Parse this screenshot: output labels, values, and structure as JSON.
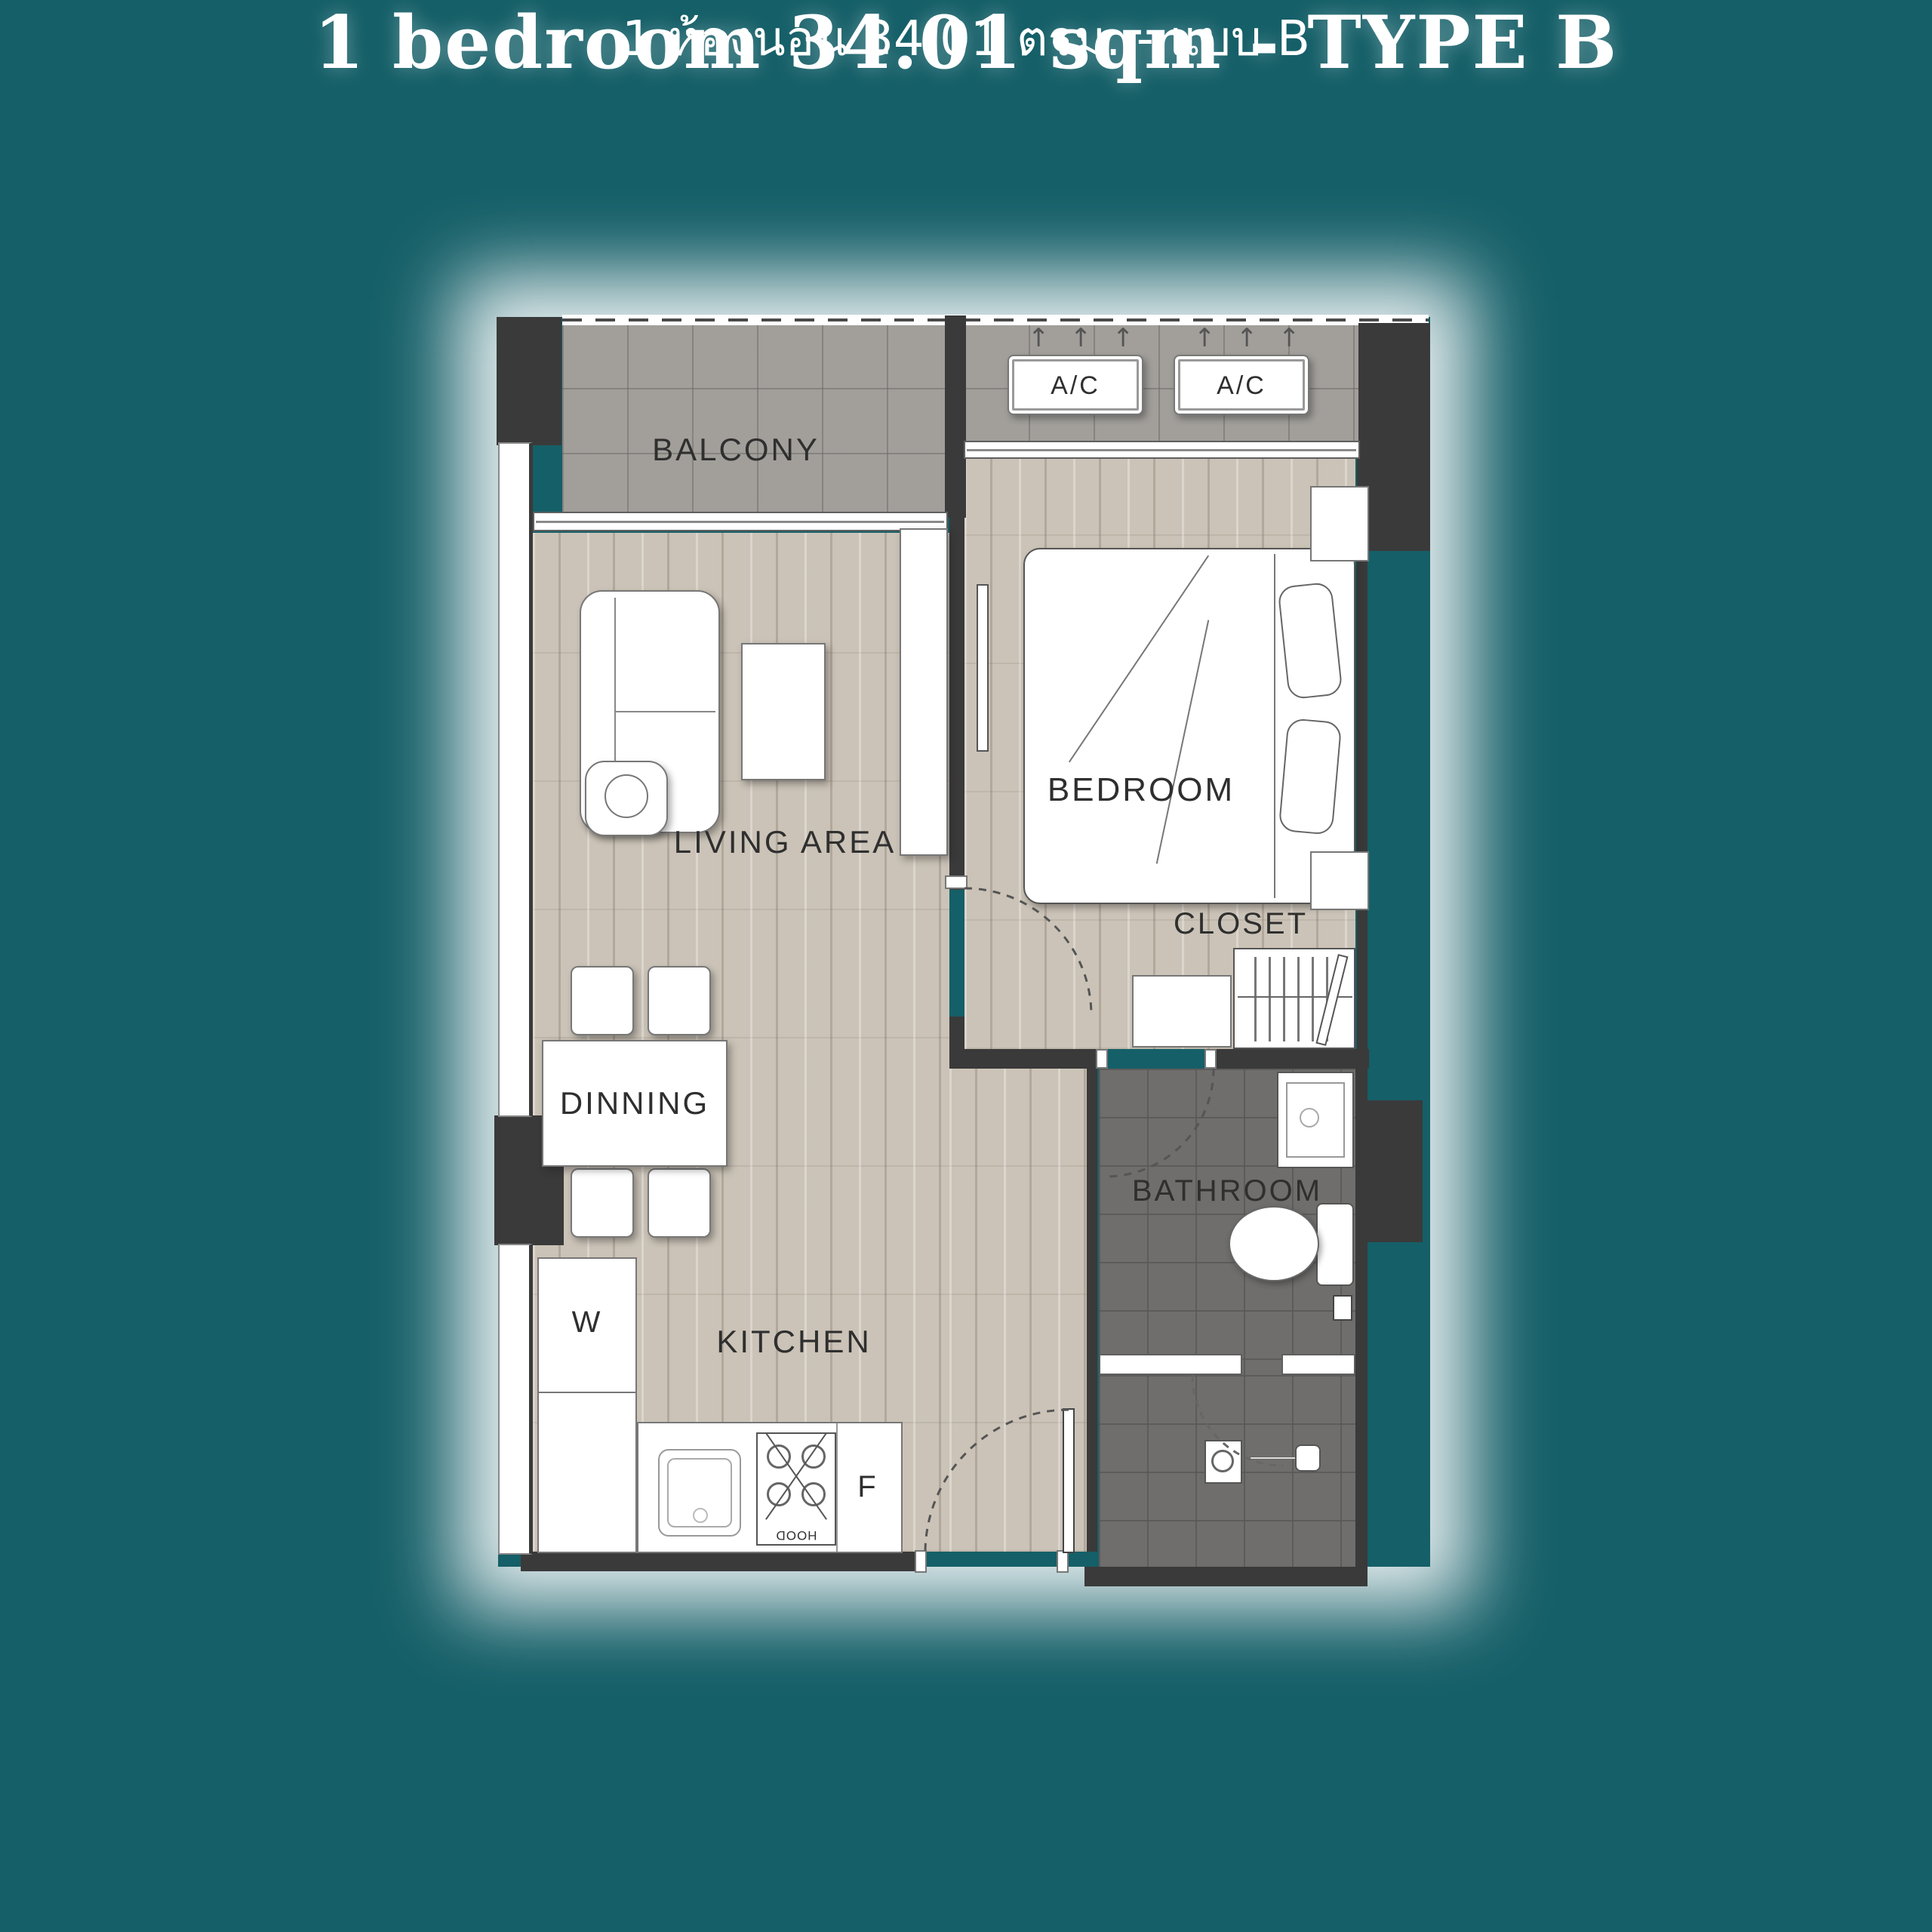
{
  "page": {
    "background": "#155F68"
  },
  "title": {
    "main": "1 bedroom 34.01 sqm - TYPE B",
    "sub": "1 ห้องนอน 34.01 ตรม. - แบบ B"
  },
  "plan": {
    "rooms": {
      "balcony": "BALCONY",
      "living_area": "LIVING AREA",
      "dining": "DINNING",
      "kitchen": "KITCHEN",
      "bedroom": "BEDROOM",
      "closet": "CLOSET",
      "bathroom": "BATHROOM"
    },
    "fixtures": {
      "ac": "A/C",
      "washer": "W",
      "fridge": "F",
      "hood": "HOOD"
    },
    "colors": {
      "wall": "#3A3A3A",
      "wood_floor": "#CBC3B7",
      "tile_light": "#A29F9B",
      "tile_dark": "#6F6E6C",
      "label_text": "#2F2F2F",
      "title_text": "#FFFFFF"
    }
  }
}
